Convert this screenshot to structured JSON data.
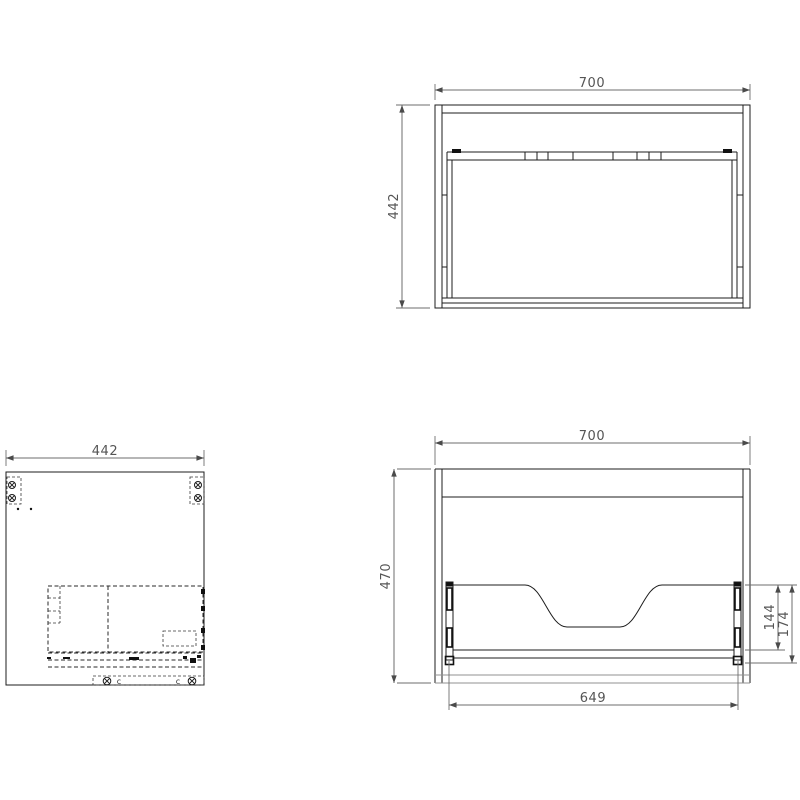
{
  "views": {
    "top": {
      "width_mm": "700",
      "depth_mm": "442"
    },
    "side": {
      "depth_mm": "442",
      "cam_letter_left": "c",
      "cam_letter_right": "c"
    },
    "front": {
      "width_mm": "700",
      "height_mm": "470",
      "inner_width_mm": "649",
      "panel_height_mm": "144",
      "rail_height_mm": "174"
    }
  },
  "colors": {
    "line": "#1c1c1c",
    "hidden_line": "#2a2a2a",
    "dimension_line": "#6e6e6e",
    "dimension_text": "#555555",
    "light_line": "#909090",
    "background": "#ffffff"
  }
}
